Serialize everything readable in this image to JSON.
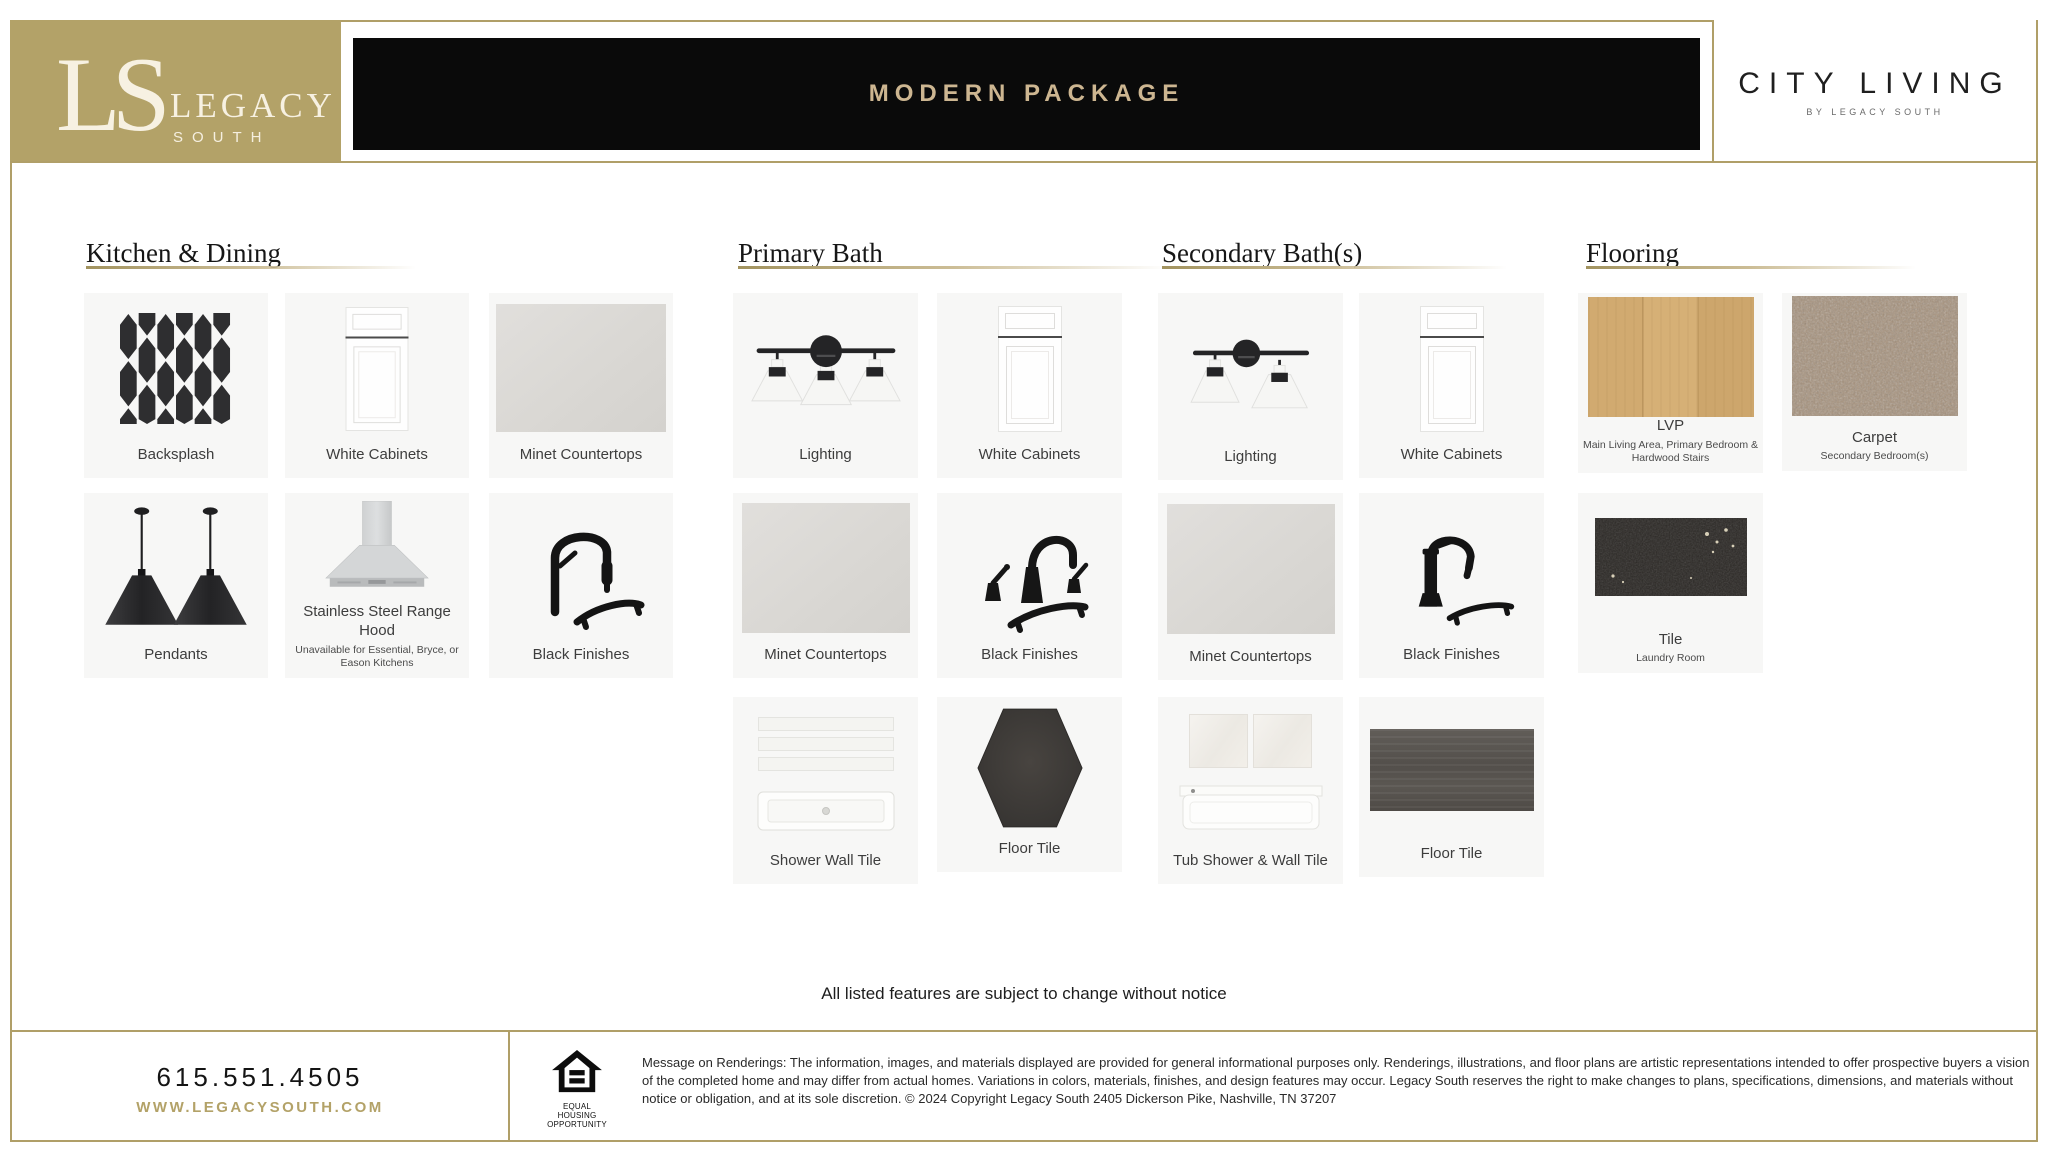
{
  "brand": {
    "monogram": "LS",
    "name_line1": "LEGACY",
    "name_line2": "SOUTH",
    "collection": "CITY LIVING",
    "collection_sub": "BY LEGACY SOUTH"
  },
  "title": "MODERN PACKAGE",
  "colors": {
    "gold": "#b3a268",
    "title_gold": "#cdb691",
    "header_black": "#0a0a0a",
    "card_background": "#f7f7f6"
  },
  "sections": {
    "kitchen": {
      "title": "Kitchen & Dining",
      "items": {
        "backsplash": {
          "label": "Backsplash"
        },
        "white_cabinets": {
          "label": "White Cabinets"
        },
        "minet_countertops": {
          "label": "Minet Countertops"
        },
        "pendants": {
          "label": "Pendants"
        },
        "range_hood": {
          "label": "Stainless Steel Range Hood",
          "sublabel": "Unavailable for Essential, Bryce, or Eason Kitchens"
        },
        "black_finishes": {
          "label": "Black Finishes"
        }
      }
    },
    "primary_bath": {
      "title": "Primary Bath",
      "items": {
        "lighting": {
          "label": "Lighting"
        },
        "white_cabinets": {
          "label": "White Cabinets"
        },
        "minet_countertops": {
          "label": "Minet Countertops"
        },
        "black_finishes": {
          "label": "Black Finishes"
        },
        "shower_wall_tile": {
          "label": "Shower Wall Tile"
        },
        "floor_tile": {
          "label": "Floor Tile"
        }
      }
    },
    "secondary_bath": {
      "title": "Secondary Bath(s)",
      "items": {
        "lighting": {
          "label": "Lighting"
        },
        "white_cabinets": {
          "label": "White Cabinets"
        },
        "minet_countertops": {
          "label": "Minet Countertops"
        },
        "black_finishes": {
          "label": "Black Finishes"
        },
        "tub_shower": {
          "label": "Tub Shower & Wall Tile"
        },
        "floor_tile": {
          "label": "Floor Tile"
        }
      }
    },
    "flooring": {
      "title": "Flooring",
      "items": {
        "lvp": {
          "label": "LVP",
          "sublabel": "Main Living Area, Primary Bedroom & Hardwood Stairs"
        },
        "carpet": {
          "label": "Carpet",
          "sublabel": "Secondary Bedroom(s)"
        },
        "tile": {
          "label": "Tile",
          "sublabel": "Laundry Room"
        }
      }
    }
  },
  "notice": "All listed features are subject to change without notice",
  "footer": {
    "phone": "615.551.4505",
    "website": "WWW.LEGACYSOUTH.COM",
    "equal_housing_label": "EQUAL HOUSING OPPORTUNITY",
    "legal": "Message on Renderings: The information, images, and materials displayed are provided for general informational purposes only. Renderings, illustrations, and floor plans are artistic representations intended to offer prospective buyers a vision of the completed home and may differ from actual homes. Variations in colors, materials, finishes, and design features may occur. Legacy South reserves the right to make changes to plans, specifications, dimensions, and materials without notice or obligation, and at its sole discretion.  © 2024 Copyright Legacy South 2405 Dickerson Pike, Nashville, TN 37207"
  }
}
